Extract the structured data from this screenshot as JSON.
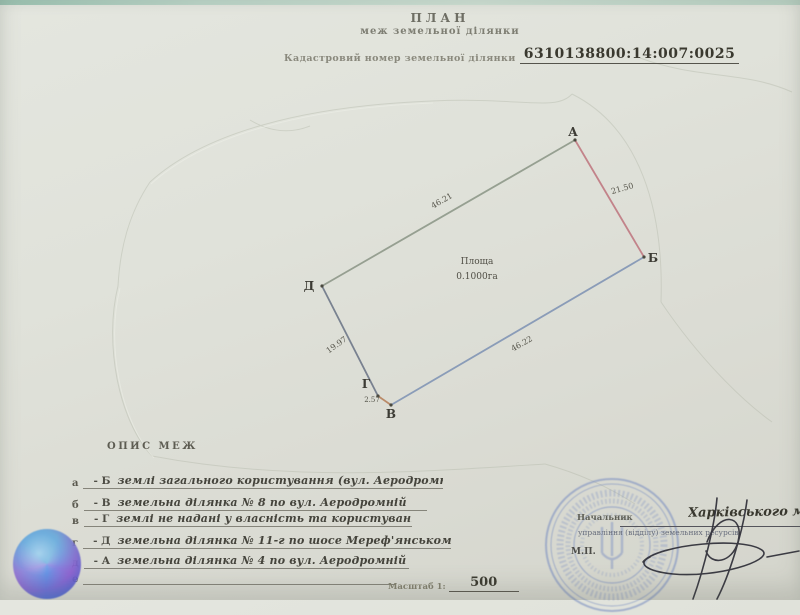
{
  "header": {
    "title": "ПЛАН",
    "subtitle": "меж земельної ділянки",
    "cadastral_label": "Кадастровий номер земельної ділянки",
    "cadastral_number": "6310138800:14:007:0025"
  },
  "plot": {
    "area_label": "Площа",
    "area_value": "0.1000га",
    "vertices": [
      {
        "name": "А"
      },
      {
        "name": "Б"
      },
      {
        "name": "В"
      },
      {
        "name": "Г"
      },
      {
        "name": "Д"
      }
    ],
    "sides": [
      {
        "from": "Д",
        "to": "А",
        "length": "46.21",
        "color": "#8f998a"
      },
      {
        "from": "А",
        "to": "Б",
        "length": "21.50",
        "color": "#c07a82"
      },
      {
        "from": "Б",
        "to": "В",
        "length": "46.22",
        "color": "#8295b5"
      },
      {
        "from": "В",
        "to": "Г",
        "length": "2.57",
        "color": "#b7825d"
      },
      {
        "from": "Г",
        "to": "Д",
        "length": "19.97",
        "color": "#6f7889"
      }
    ]
  },
  "boundaries": {
    "heading": "ОПИС МЕЖ",
    "rows": [
      {
        "letter": "а",
        "prefix": "- Б",
        "text": "землі загального користування (вул. Аеродромна)"
      },
      {
        "letter": "б",
        "prefix": "- В",
        "text": "земельна ділянка № 8 по вул. Аеродромній"
      },
      {
        "letter": "в",
        "prefix": "- Г",
        "text": "землі не надані у власність та користування"
      },
      {
        "letter": "г",
        "prefix": "- Д",
        "text": "земельна ділянка № 11-г по шосе Мереф'янському"
      },
      {
        "letter": "д",
        "prefix": "- А",
        "text": "земельна ділянка № 4 по вул. Аеродромній"
      },
      {
        "letter": "е",
        "prefix": "",
        "text": ""
      }
    ]
  },
  "footer": {
    "scale_label": "Масштаб 1:",
    "scale_value": "500"
  },
  "approval": {
    "title_line1": "Начальник",
    "title_line2": "управління (відділу) земельних ресурсів",
    "office_handwritten": "Харківського міськ",
    "seal_mark": "М.П."
  }
}
